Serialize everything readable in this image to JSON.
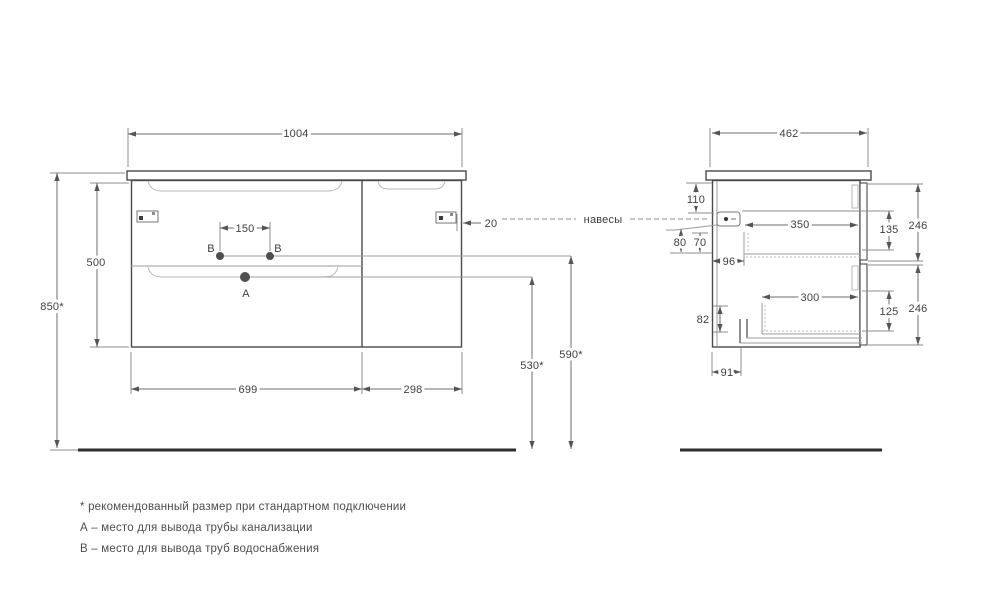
{
  "page": {
    "background": "#ffffff",
    "line_color": "#4a4a4a",
    "text_color": "#3f3f3f"
  },
  "front_view": {
    "overall_width": "1004",
    "overall_height": "850*",
    "cabinet_height": "500",
    "faucet_holes_spacing": "150",
    "hanger_edge_offset": "20",
    "left_section_width": "699",
    "right_section_width": "298",
    "drain_outlet_height": "530*",
    "water_outlet_height": "590*",
    "point_a_label": "А",
    "point_b_label": "В"
  },
  "side_view": {
    "depth": "462",
    "hanger_top_offset": "110",
    "dim_80": "80",
    "dim_70": "70",
    "drawer_back_gap": "96",
    "top_drawer_depth": "350",
    "dim_135": "135",
    "top_drawer_front_height": "246",
    "bottom_drawer_depth": "300",
    "dim_82": "82",
    "dim_125": "125",
    "bottom_drawer_front_height": "246",
    "siphon_cutout_offset": "91"
  },
  "callout": {
    "hangers_label": "навесы"
  },
  "footnotes": [
    "* рекомендованный размер при стандартном подключении",
    "А – место для вывода трубы канализации",
    "В – место для вывода труб водоснабжения"
  ]
}
